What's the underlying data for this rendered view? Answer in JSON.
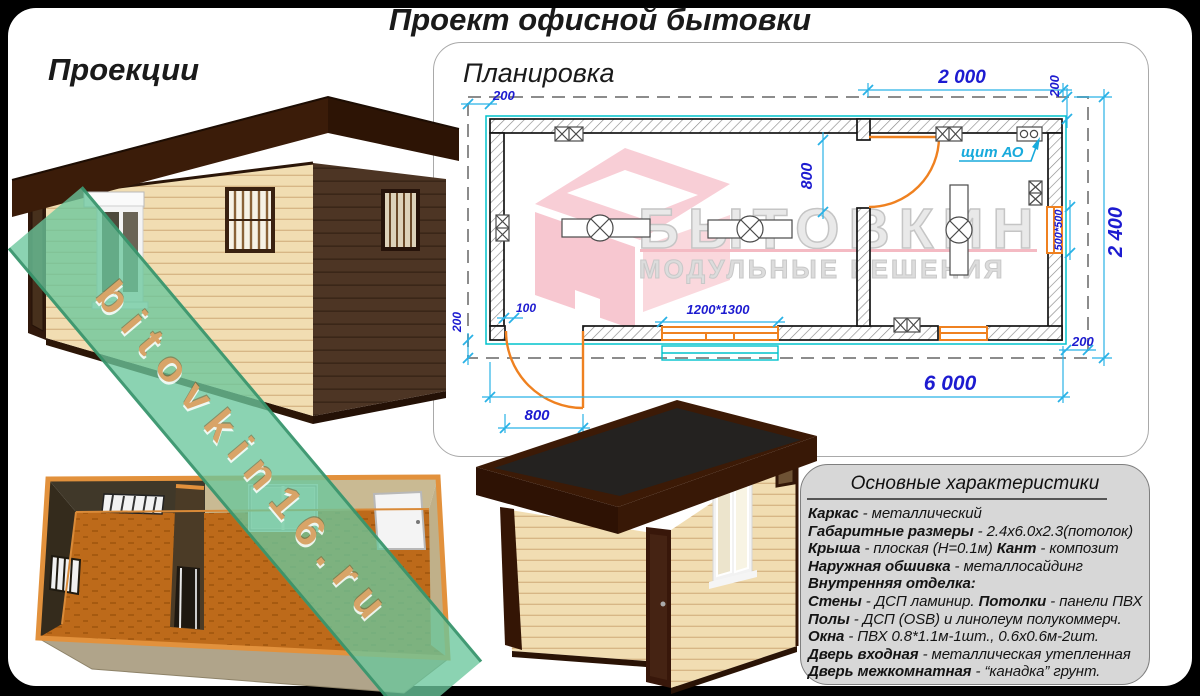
{
  "page": {
    "title": "Проект офисной бытовки"
  },
  "sections": {
    "projections_heading": "Проекции",
    "plan_heading": "Планировка"
  },
  "plan": {
    "dims": {
      "top_left_offset": "200",
      "room2_width": "2 000",
      "top_right_offset": "200",
      "overall_width": "2 400",
      "side_window": "500*500",
      "bottom_right_offset": "200",
      "interior_door_opening": "800",
      "entry_door_offset": "100",
      "bottom_left_offset": "200",
      "overall_length": "6 000",
      "entry_door_width": "800",
      "front_window": "1200*1300"
    },
    "labels": {
      "electrical_panel": "щит АО"
    }
  },
  "watermarks": {
    "site": "bitovkin16.ru",
    "brand_name": "БЫТОВКИН",
    "brand_tagline": "МОДУЛЬНЫЕ РЕШЕНИЯ"
  },
  "specs": {
    "heading": "Основные характеристики",
    "rows": [
      [
        {
          "b": "Каркас"
        },
        {
          "t": " - металлический"
        }
      ],
      [
        {
          "b": "Габаритные размеры"
        },
        {
          "t": " - 2.4х6.0х2.3(потолок)"
        }
      ],
      [
        {
          "b": "Крыша"
        },
        {
          "t": " - плоская (Н=0.1м) "
        },
        {
          "b": "Кант"
        },
        {
          "t": " - композит"
        }
      ],
      [
        {
          "b": "Наружная обшивка"
        },
        {
          "t": " - металлосайдинг"
        }
      ],
      [
        {
          "b": "Внутренняя отделка:"
        }
      ],
      [
        {
          "b": "Стены"
        },
        {
          "t": " - ДСП ламинир. "
        },
        {
          "b": "Потолки"
        },
        {
          "t": " - панели ПВХ"
        }
      ],
      [
        {
          "b": "Полы"
        },
        {
          "t": " - ДСП (OSB) и линолеум полукоммерч."
        }
      ],
      [
        {
          "b": "Окна"
        },
        {
          "t": " - ПВХ 0.8*1.1м-1шт., 0.6х0.6м-2шт."
        }
      ],
      [
        {
          "b": "Дверь входная"
        },
        {
          "t": " - металлическая утепленная"
        }
      ],
      [
        {
          "b": "Дверь межкомнатная"
        },
        {
          "t": " - “канадка” грунт."
        }
      ]
    ]
  },
  "colors": {
    "dimension_cyan": "#29b2e6",
    "dimension_label_blue": "#1d1bd0",
    "joinery_orange": "#ef8120",
    "watermark_green": "#6ac69c",
    "watermark_pink": "#f8c9d2",
    "roof_brown": "#3b1c09",
    "siding_cream": "#f1ddb2"
  }
}
